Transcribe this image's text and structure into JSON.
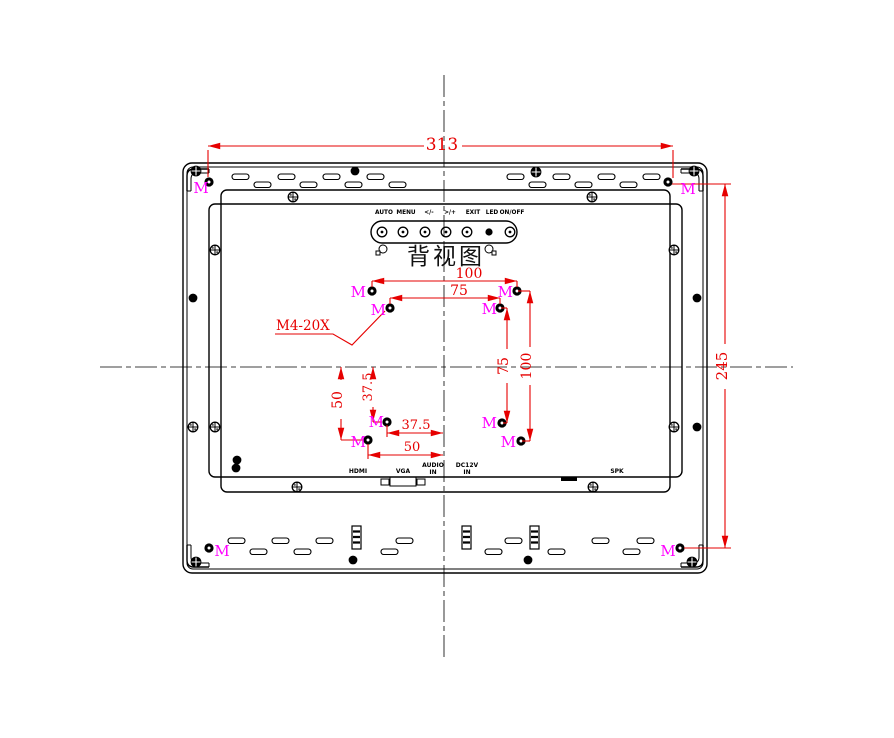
{
  "drawing": {
    "title": "背视图"
  },
  "controls": {
    "labels": [
      "AUTO",
      "MENU",
      "</-",
      ">/+",
      "EXIT",
      "LED",
      "ON/OFF"
    ]
  },
  "ports": {
    "hdmi": "HDMI",
    "vga": "VGA",
    "audio1": "AUDIO",
    "audio2": "IN",
    "dc1": "DC12V",
    "dc2": "IN",
    "spk": "SPK"
  },
  "dimensions": {
    "overall_width": "313",
    "overall_height": "245",
    "vesa100_horizontal": "100",
    "vesa75_horizontal": "75",
    "vesa75_vertical": "75",
    "vesa100_vertical": "100",
    "offset50_vertical": "50",
    "offset37_5_vertical": "37.5",
    "offset37_5_horizontal": "37.5",
    "offset50_horizontal": "50"
  },
  "annotations": {
    "screw_mark": "M",
    "screw_note": "M4-20X"
  },
  "colors": {
    "dimension_red": "#e60000",
    "screw_magenta": "#ff00ff",
    "line_black": "#000000"
  }
}
